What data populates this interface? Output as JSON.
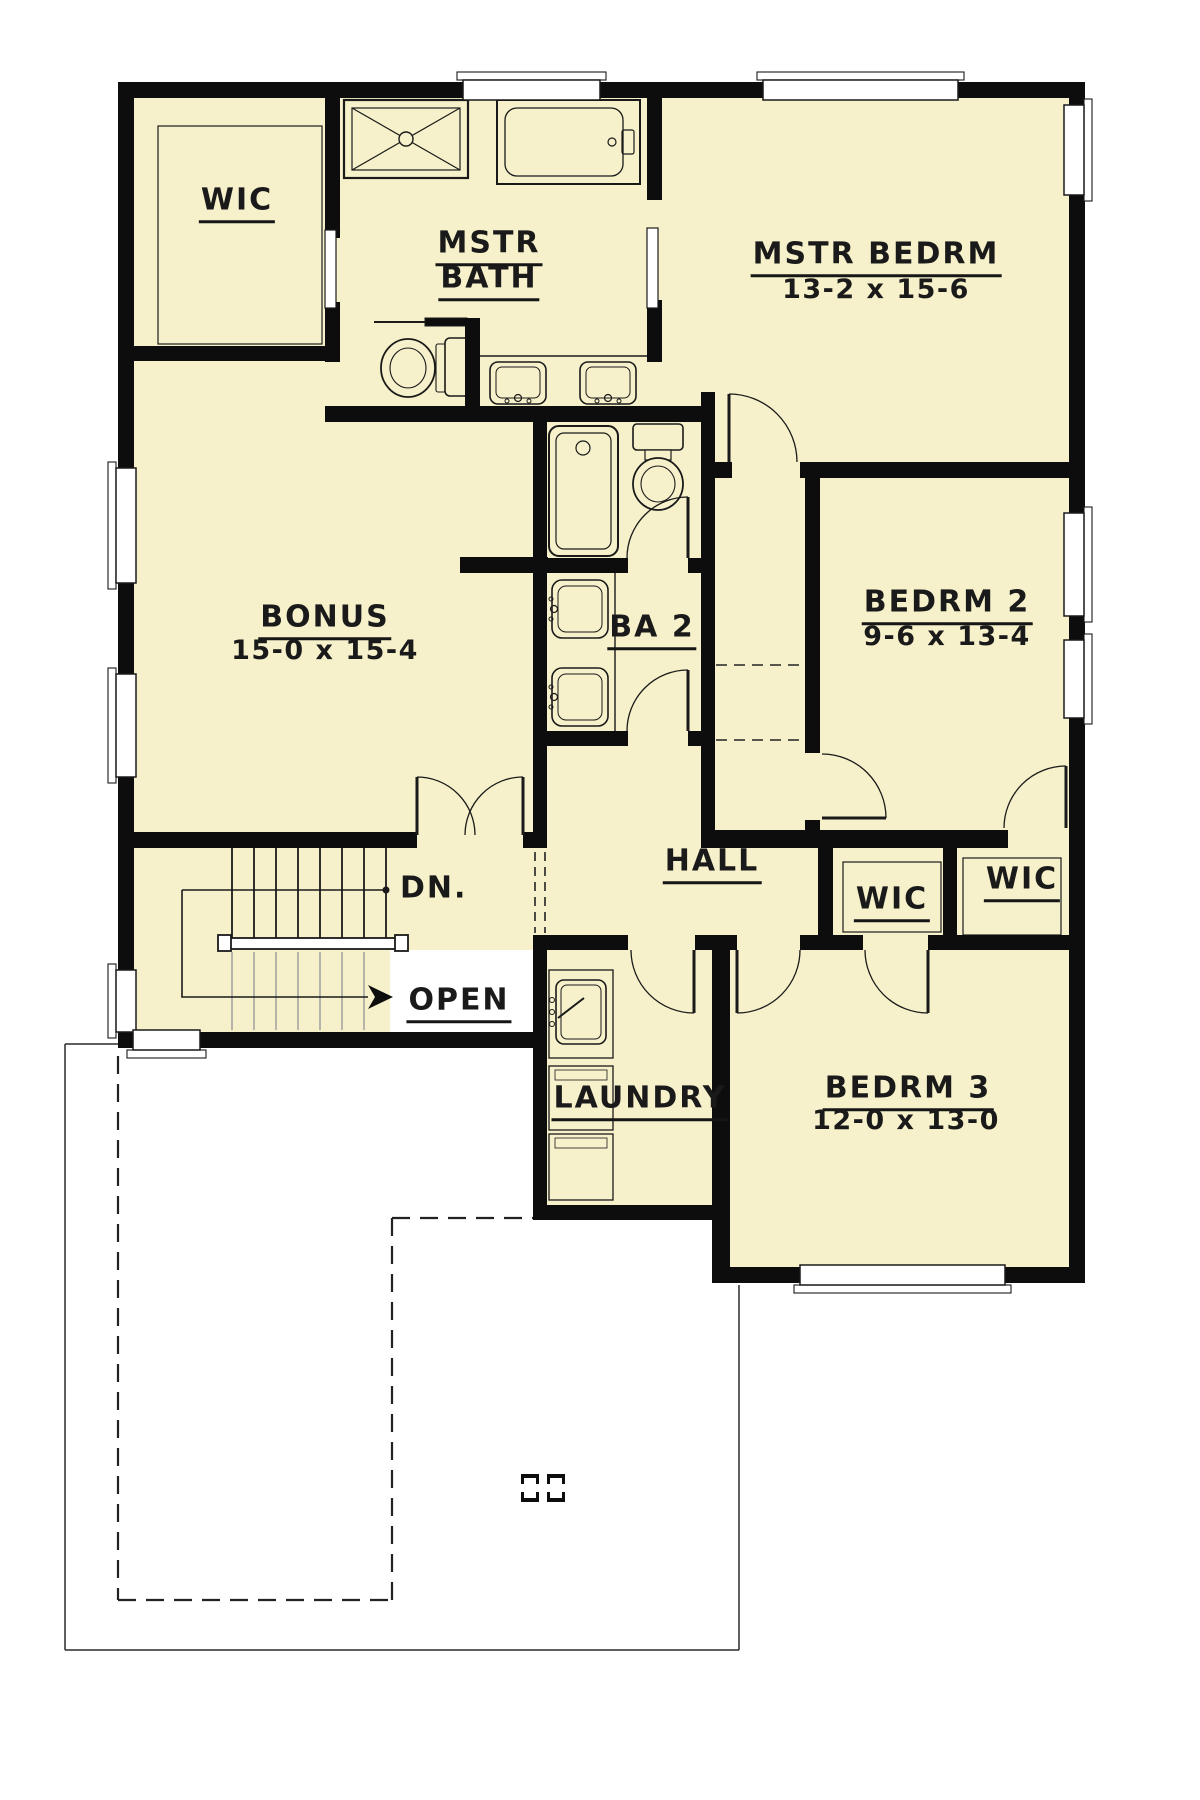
{
  "colors": {
    "floor": "#F6F1CA",
    "wall": "#0d0d0d",
    "line": "#1a1a1a",
    "gray_tread": "#9a9a9a",
    "page": "#ffffff"
  },
  "rooms": [
    {
      "id": "wic-master",
      "label": "WIC",
      "x": 237,
      "y": 200,
      "u": true
    },
    {
      "id": "mstr-bath-line1",
      "label": "MSTR",
      "x": 489,
      "y": 243,
      "u": true
    },
    {
      "id": "mstr-bath-line2",
      "label": "BATH",
      "x": 489,
      "y": 278,
      "u": true
    },
    {
      "id": "mstr-bedrm",
      "label": "MSTR BEDRM",
      "x": 876,
      "y": 254,
      "u": true
    },
    {
      "id": "mstr-bedrm-dims",
      "label": "13-2 x 15-6",
      "x": 876,
      "y": 290,
      "dims": true
    },
    {
      "id": "bonus",
      "label": "BONUS",
      "x": 325,
      "y": 617,
      "u": true
    },
    {
      "id": "bonus-dims",
      "label": "15-0 x 15-4",
      "x": 325,
      "y": 651,
      "dims": true
    },
    {
      "id": "ba2",
      "label": "BA 2",
      "x": 652,
      "y": 627,
      "u": true
    },
    {
      "id": "bedrm2",
      "label": "BEDRM 2",
      "x": 947,
      "y": 602,
      "u": true
    },
    {
      "id": "bedrm2-dims",
      "label": "9-6 x 13-4",
      "x": 947,
      "y": 637,
      "dims": true
    },
    {
      "id": "hall",
      "label": "HALL",
      "x": 712,
      "y": 861,
      "u": true
    },
    {
      "id": "wic-bedrm3",
      "label": "WIC",
      "x": 892,
      "y": 899,
      "u": true
    },
    {
      "id": "wic-bedrm2",
      "label": "WIC",
      "x": 1022,
      "y": 879,
      "u": true
    },
    {
      "id": "laundry",
      "label": "LAUNDRY",
      "x": 640,
      "y": 1098,
      "u": true
    },
    {
      "id": "bedrm3",
      "label": "BEDRM 3",
      "x": 908,
      "y": 1088,
      "u": true
    },
    {
      "id": "bedrm3-dims",
      "label": "12-0 x 13-0",
      "x": 906,
      "y": 1121,
      "dims": true
    }
  ],
  "annotations": [
    {
      "id": "dn",
      "label": "DN.",
      "x": 398,
      "y": 888,
      "anchor": "left"
    },
    {
      "id": "open",
      "label": "OPEN",
      "x": 459,
      "y": 1000,
      "u": true
    }
  ],
  "geometry": {
    "floor_rects": [
      [
        118,
        82,
        967,
        966
      ],
      [
        533,
        950,
        197,
        270
      ],
      [
        712,
        950,
        373,
        333
      ]
    ],
    "open_void": [
      390,
      950,
      143,
      82
    ],
    "walls": [
      [
        118,
        82,
        967,
        16
      ],
      [
        118,
        82,
        16,
        966
      ],
      [
        1069,
        82,
        16,
        1201
      ],
      [
        118,
        1032,
        429,
        16
      ],
      [
        325,
        98,
        15,
        140
      ],
      [
        325,
        302,
        15,
        60
      ],
      [
        134,
        346,
        206,
        15
      ],
      [
        325,
        406,
        390,
        16
      ],
      [
        647,
        98,
        15,
        102
      ],
      [
        647,
        300,
        15,
        62
      ],
      [
        465,
        318,
        15,
        92
      ],
      [
        701,
        392,
        14,
        438
      ],
      [
        715,
        462,
        17,
        16
      ],
      [
        800,
        462,
        269,
        16
      ],
      [
        805,
        463,
        15,
        290
      ],
      [
        805,
        820,
        15,
        28
      ],
      [
        701,
        830,
        307,
        18
      ],
      [
        818,
        848,
        15,
        102
      ],
      [
        943,
        848,
        14,
        102
      ],
      [
        533,
        935,
        95,
        15
      ],
      [
        695,
        935,
        42,
        15
      ],
      [
        800,
        935,
        63,
        15
      ],
      [
        928,
        935,
        141,
        15
      ],
      [
        533,
        406,
        14,
        426
      ],
      [
        523,
        832,
        24,
        16
      ],
      [
        134,
        832,
        283,
        16
      ],
      [
        533,
        950,
        14,
        270
      ],
      [
        712,
        950,
        18,
        333
      ],
      [
        533,
        1205,
        197,
        15
      ],
      [
        712,
        1267,
        88,
        16
      ],
      [
        1005,
        1267,
        80,
        16
      ],
      [
        460,
        557,
        88,
        16
      ],
      [
        547,
        558,
        81,
        15
      ],
      [
        688,
        558,
        13,
        15
      ],
      [
        547,
        731,
        81,
        15
      ],
      [
        688,
        731,
        13,
        15
      ]
    ],
    "windows": [
      [
        463,
        80,
        137,
        20,
        457,
        72,
        149,
        8
      ],
      [
        763,
        80,
        195,
        20,
        757,
        72,
        207,
        8
      ],
      [
        116,
        468,
        20,
        115,
        108,
        462,
        8,
        127
      ],
      [
        116,
        674,
        20,
        103,
        108,
        668,
        8,
        115
      ],
      [
        116,
        970,
        20,
        62,
        108,
        964,
        8,
        74
      ],
      [
        1064,
        105,
        20,
        90,
        1084,
        99,
        8,
        102
      ],
      [
        1064,
        513,
        20,
        103,
        1084,
        507,
        8,
        115
      ],
      [
        1064,
        640,
        20,
        78,
        1084,
        634,
        8,
        90
      ],
      [
        133,
        1030,
        67,
        20,
        127,
        1050,
        79,
        8
      ],
      [
        800,
        1265,
        205,
        20,
        794,
        1285,
        217,
        8
      ]
    ],
    "pocket_doors": [
      [
        325,
        230,
        11,
        78
      ],
      [
        647,
        228,
        11,
        80
      ]
    ],
    "doors": [
      {
        "id": "bonus-double-left",
        "leaf": [
          417,
          777,
          417,
          835
        ],
        "arc": "M417,777 A58,58 0 0 1 475,835"
      },
      {
        "id": "bonus-double-right",
        "leaf": [
          523,
          777,
          523,
          835
        ],
        "arc": "M523,777 A58,58 0 0 0 465,835"
      },
      {
        "id": "mstr-bedrm-door",
        "leaf": [
          729,
          394,
          729,
          462
        ],
        "arc": "M729,394 A68,68 0 0 1 797,462"
      },
      {
        "id": "ba2-inner-door",
        "leaf": [
          688,
          497,
          688,
          558
        ],
        "arc": "M688,497 A61,61 0 0 0 627,558"
      },
      {
        "id": "ba2-entry-door",
        "leaf": [
          688,
          670,
          688,
          731
        ],
        "arc": "M688,670 A61,61 0 0 0 627,731"
      },
      {
        "id": "bedrm2-door",
        "leaf": [
          822,
          818,
          886,
          818
        ],
        "arc": "M822,754 A64,64 0 0 1 886,818"
      },
      {
        "id": "wic-bedrm2-door",
        "leaf": [
          1066,
          766,
          1066,
          828
        ],
        "arc": "M1066,766 A62,62 0 0 0 1004,828"
      },
      {
        "id": "laundry-door",
        "leaf": [
          694,
          950,
          694,
          1013
        ],
        "arc": "M631,950 A63,63 0 0 0 694,1013"
      },
      {
        "id": "bedrm3-door",
        "leaf": [
          737,
          950,
          737,
          1013
        ],
        "arc": "M737,1013 A63,63 0 0 0 800,950"
      },
      {
        "id": "wic-bedrm3-door",
        "leaf": [
          928,
          950,
          928,
          1013
        ],
        "arc": "M865,950 A63,63 0 0 0 928,1013"
      }
    ],
    "dashed": [
      [
        535,
        852,
        535,
        933,
        "9 6",
        1.6
      ],
      [
        545,
        852,
        545,
        933,
        "9 6",
        1.6
      ],
      [
        716,
        665,
        805,
        665,
        "11 7",
        1.6
      ],
      [
        716,
        740,
        805,
        740,
        "11 7",
        1.6
      ],
      [
        118,
        1056,
        118,
        1600,
        "18 10",
        2.2
      ],
      [
        118,
        1600,
        392,
        1600,
        "18 10",
        2.2
      ],
      [
        392,
        1218,
        392,
        1600,
        "18 10",
        2.2
      ],
      [
        392,
        1218,
        533,
        1218,
        "18 10",
        2.2
      ]
    ],
    "outline": [
      [
        65,
        1044,
        118,
        1044
      ],
      [
        65,
        1044,
        65,
        1650
      ],
      [
        65,
        1650,
        739,
        1650
      ],
      [
        739,
        1650,
        739,
        1285
      ]
    ],
    "stairs": {
      "treads_x": [
        232,
        254,
        276,
        298,
        320,
        342,
        364,
        386
      ],
      "treads_y": [
        848,
        940
      ],
      "lower_x": [
        232,
        254,
        276,
        298,
        320,
        342,
        364
      ],
      "lower_y": [
        952,
        1030
      ],
      "rail": [
        222,
        938,
        180,
        11
      ],
      "posts": [
        [
          218,
          935,
          13,
          16
        ],
        [
          395,
          935,
          13,
          16
        ]
      ],
      "leader_h": [
        182,
        890,
        386,
        890
      ],
      "dot": [
        386,
        890,
        3.5
      ],
      "leader_path": [
        [
          182,
          890
        ],
        [
          182,
          997
        ],
        [
          368,
          997
        ]
      ],
      "arrow": "368,985 393,997 368,1009 375,997"
    },
    "columns": [
      [
        521,
        1474
      ],
      [
        547,
        1474
      ]
    ],
    "fixtures": [
      {
        "n": "shower",
        "s": [
          [
            "r",
            344,
            100,
            124,
            78,
            0,
            2.2,
            "n"
          ],
          [
            "r",
            352,
            108,
            108,
            62,
            0,
            1.2,
            "n"
          ],
          [
            "l",
            352,
            108,
            460,
            170,
            1.2
          ],
          [
            "l",
            352,
            170,
            460,
            108,
            1.2
          ],
          [
            "c",
            406,
            139,
            7,
            1.4,
            "f"
          ]
        ]
      },
      {
        "n": "master-bathtub",
        "s": [
          [
            "r",
            497,
            100,
            143,
            84,
            0,
            2,
            "n"
          ],
          [
            "r",
            505,
            108,
            118,
            68,
            12,
            1.3,
            "n"
          ],
          [
            "r",
            622,
            130,
            12,
            24,
            2,
            1.2,
            "n"
          ],
          [
            "c",
            612,
            142,
            4,
            1.2,
            "n"
          ]
        ]
      },
      {
        "n": "master-toilet",
        "s": [
          [
            "l",
            374,
            322,
            425,
            322,
            2
          ],
          [
            "r",
            425,
            318,
            42,
            8,
            0,
            1,
            "b"
          ],
          [
            "r",
            436,
            344,
            10,
            48,
            2,
            1.1,
            "f"
          ],
          [
            "r",
            445,
            338,
            24,
            58,
            5,
            1.6,
            "f"
          ],
          [
            "e",
            408,
            368,
            27,
            29,
            1.8,
            "f"
          ],
          [
            "e",
            408,
            368,
            18,
            20,
            1.1,
            "n"
          ]
        ]
      },
      {
        "n": "master-vanity-sinks",
        "s": [
          [
            "l",
            480,
            356,
            647,
            356,
            1.4
          ],
          [
            "r",
            490,
            362,
            56,
            42,
            8,
            1.6,
            "f"
          ],
          [
            "r",
            496,
            367,
            44,
            31,
            6,
            1,
            "n"
          ],
          [
            "c",
            518,
            398,
            3.5,
            1.2,
            "n"
          ],
          [
            "c",
            507,
            401,
            2,
            1,
            "n"
          ],
          [
            "c",
            529,
            401,
            2,
            1,
            "n"
          ],
          [
            "r",
            580,
            362,
            56,
            42,
            8,
            1.6,
            "f"
          ],
          [
            "r",
            586,
            367,
            44,
            31,
            6,
            1,
            "n"
          ],
          [
            "c",
            608,
            398,
            3.5,
            1.2,
            "n"
          ],
          [
            "c",
            597,
            401,
            2,
            1,
            "n"
          ],
          [
            "c",
            619,
            401,
            2,
            1,
            "n"
          ]
        ]
      },
      {
        "n": "ba2-bathtub",
        "s": [
          [
            "r",
            549,
            426,
            69,
            130,
            10,
            2,
            "n"
          ],
          [
            "r",
            556,
            433,
            55,
            116,
            8,
            1.2,
            "n"
          ],
          [
            "c",
            583,
            448,
            7,
            1.2,
            "n"
          ]
        ]
      },
      {
        "n": "ba2-toilet",
        "s": [
          [
            "r",
            633,
            424,
            50,
            26,
            4,
            1.6,
            "f"
          ],
          [
            "r",
            645,
            450,
            26,
            10,
            0,
            1.2,
            "f"
          ],
          [
            "e",
            658,
            484,
            25,
            26,
            1.8,
            "f"
          ],
          [
            "e",
            658,
            484,
            17,
            18,
            1.1,
            "n"
          ]
        ]
      },
      {
        "n": "ba2-vanity-sinks",
        "s": [
          [
            "l",
            615,
            573,
            615,
            731,
            1.4
          ],
          [
            "r",
            552,
            580,
            56,
            58,
            10,
            1.6,
            "f"
          ],
          [
            "r",
            558,
            586,
            44,
            46,
            8,
            1,
            "n"
          ],
          [
            "c",
            554,
            609,
            3.5,
            1.2,
            "n"
          ],
          [
            "c",
            551,
            599,
            2,
            1,
            "n"
          ],
          [
            "c",
            551,
            619,
            2,
            1,
            "n"
          ],
          [
            "r",
            552,
            668,
            56,
            58,
            10,
            1.6,
            "f"
          ],
          [
            "r",
            558,
            674,
            44,
            46,
            8,
            1,
            "n"
          ],
          [
            "c",
            554,
            697,
            3.5,
            1.2,
            "n"
          ],
          [
            "c",
            551,
            687,
            2,
            1,
            "n"
          ],
          [
            "c",
            551,
            707,
            2,
            1,
            "n"
          ]
        ]
      },
      {
        "n": "laundry-sink",
        "s": [
          [
            "r",
            549,
            970,
            64,
            88,
            0,
            1.3,
            "n"
          ],
          [
            "r",
            556,
            980,
            50,
            64,
            8,
            1.6,
            "f"
          ],
          [
            "r",
            561,
            985,
            40,
            54,
            6,
            1,
            "n"
          ],
          [
            "c",
            552,
            1000,
            2.5,
            1,
            "n"
          ],
          [
            "c",
            552,
            1012,
            2.5,
            1,
            "n"
          ],
          [
            "c",
            552,
            1024,
            2.5,
            1,
            "n"
          ],
          [
            "l",
            558,
            1018,
            584,
            998,
            2
          ]
        ]
      },
      {
        "n": "washer",
        "s": [
          [
            "r",
            549,
            1066,
            64,
            64,
            0,
            1.3,
            "n"
          ],
          [
            "r",
            555,
            1070,
            52,
            10,
            0,
            0.8,
            "n"
          ]
        ]
      },
      {
        "n": "dryer",
        "s": [
          [
            "r",
            549,
            1134,
            64,
            66,
            0,
            1.3,
            "n"
          ],
          [
            "r",
            555,
            1138,
            52,
            10,
            0,
            0.8,
            "n"
          ]
        ]
      },
      {
        "n": "wic-master-shelves",
        "s": [
          [
            "r",
            158,
            126,
            164,
            218,
            0,
            1.2,
            "n"
          ]
        ]
      },
      {
        "n": "wic-bedrm3-shelves",
        "s": [
          [
            "r",
            843,
            862,
            98,
            70,
            0,
            1.2,
            "n"
          ]
        ]
      },
      {
        "n": "wic-bedrm2-shelves",
        "s": [
          [
            "r",
            963,
            858,
            98,
            77,
            0,
            1.2,
            "n"
          ]
        ]
      }
    ]
  }
}
